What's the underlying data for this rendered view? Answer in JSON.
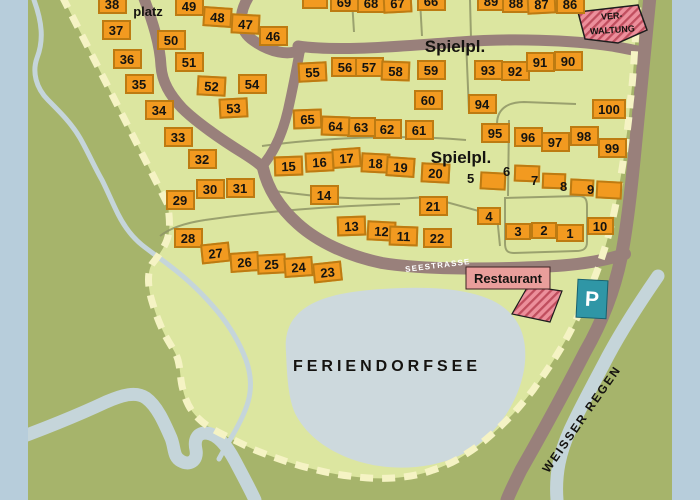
{
  "labels": {
    "spielplatz_partial": "platz",
    "spielplatz_top": "Spielpl.",
    "spielplatz_mid": "Spielpl.",
    "verwaltung_line1": "VER-",
    "verwaltung_line2": "WALTUNG",
    "seestrasse": "SEESTRASSE",
    "restaurant": "Restaurant",
    "parking": "P",
    "lake": "FERIENDORFSEE",
    "river": "WEISSER REGEN"
  },
  "plots": [
    {
      "n": "38",
      "x": 112,
      "y": 4
    },
    {
      "n": "37",
      "x": 116,
      "y": 30
    },
    {
      "n": "36",
      "x": 127,
      "y": 59
    },
    {
      "n": "35",
      "x": 139,
      "y": 84
    },
    {
      "n": "34",
      "x": 159,
      "y": 110
    },
    {
      "n": "33",
      "x": 178,
      "y": 137
    },
    {
      "n": "32",
      "x": 202,
      "y": 159
    },
    {
      "n": "30",
      "x": 210,
      "y": 189
    },
    {
      "n": "31",
      "x": 240,
      "y": 188
    },
    {
      "n": "29",
      "x": 180,
      "y": 200
    },
    {
      "n": "28",
      "x": 188,
      "y": 238
    },
    {
      "n": "27",
      "x": 215,
      "y": 253,
      "r": -6
    },
    {
      "n": "26",
      "x": 244,
      "y": 262,
      "r": -4
    },
    {
      "n": "25",
      "x": 271,
      "y": 264,
      "r": -3
    },
    {
      "n": "24",
      "x": 298,
      "y": 267,
      "r": -4
    },
    {
      "n": "23",
      "x": 327,
      "y": 272,
      "r": -6
    },
    {
      "n": "49",
      "x": 189,
      "y": 6
    },
    {
      "n": "48",
      "x": 217,
      "y": 17,
      "r": 4
    },
    {
      "n": "47",
      "x": 245,
      "y": 24,
      "r": 3
    },
    {
      "n": "46",
      "x": 273,
      "y": 36
    },
    {
      "n": "50",
      "x": 171,
      "y": 40
    },
    {
      "n": "51",
      "x": 189,
      "y": 62
    },
    {
      "n": "52",
      "x": 211,
      "y": 86,
      "r": 3
    },
    {
      "n": "53",
      "x": 233,
      "y": 108,
      "r": -3
    },
    {
      "n": "54",
      "x": 252,
      "y": 84
    },
    {
      "n": "55",
      "x": 312,
      "y": 72,
      "r": -3
    },
    {
      "n": "56",
      "x": 345,
      "y": 67
    },
    {
      "n": "57",
      "x": 369,
      "y": 67
    },
    {
      "n": "58",
      "x": 395,
      "y": 71,
      "r": 2
    },
    {
      "n": "59",
      "x": 431,
      "y": 70
    },
    {
      "n": "60",
      "x": 428,
      "y": 100
    },
    {
      "n": "61",
      "x": 419,
      "y": 130
    },
    {
      "n": "62",
      "x": 387,
      "y": 129
    },
    {
      "n": "63",
      "x": 361,
      "y": 127
    },
    {
      "n": "64",
      "x": 335,
      "y": 126,
      "r": 2
    },
    {
      "n": "65",
      "x": 307,
      "y": 119,
      "r": -2
    },
    {
      "n": "",
      "x": 315,
      "y": -1,
      "w": 26
    },
    {
      "n": "69",
      "x": 344,
      "y": 2
    },
    {
      "n": "68",
      "x": 371,
      "y": 3
    },
    {
      "n": "67",
      "x": 397,
      "y": 3,
      "r": -3
    },
    {
      "n": "66",
      "x": 431,
      "y": 1
    },
    {
      "n": "89",
      "x": 491,
      "y": 1
    },
    {
      "n": "88",
      "x": 516,
      "y": 3
    },
    {
      "n": "87",
      "x": 541,
      "y": 4,
      "r": -3
    },
    {
      "n": "86",
      "x": 570,
      "y": 4
    },
    {
      "n": "93",
      "x": 488,
      "y": 70
    },
    {
      "n": "92",
      "x": 515,
      "y": 71
    },
    {
      "n": "91",
      "x": 540,
      "y": 62
    },
    {
      "n": "90",
      "x": 568,
      "y": 61
    },
    {
      "n": "94",
      "x": 482,
      "y": 104
    },
    {
      "n": "100",
      "x": 609,
      "y": 109,
      "w": 34
    },
    {
      "n": "95",
      "x": 495,
      "y": 133
    },
    {
      "n": "96",
      "x": 528,
      "y": 137
    },
    {
      "n": "97",
      "x": 555,
      "y": 142
    },
    {
      "n": "98",
      "x": 584,
      "y": 136
    },
    {
      "n": "99",
      "x": 612,
      "y": 148
    },
    {
      "n": "15",
      "x": 288,
      "y": 166,
      "r": -2
    },
    {
      "n": "16",
      "x": 319,
      "y": 162,
      "r": -3
    },
    {
      "n": "17",
      "x": 346,
      "y": 158,
      "r": -4
    },
    {
      "n": "18",
      "x": 375,
      "y": 163,
      "r": 3
    },
    {
      "n": "19",
      "x": 400,
      "y": 167,
      "r": 4
    },
    {
      "n": "20",
      "x": 435,
      "y": 173,
      "r": 3
    },
    {
      "n": "14",
      "x": 324,
      "y": 195
    },
    {
      "n": "21",
      "x": 433,
      "y": 206
    },
    {
      "n": "13",
      "x": 351,
      "y": 226,
      "r": -2
    },
    {
      "n": "12",
      "x": 381,
      "y": 231,
      "r": 3
    },
    {
      "n": "11",
      "x": 403,
      "y": 236,
      "r": 2
    },
    {
      "n": "22",
      "x": 437,
      "y": 238
    },
    {
      "n": "4",
      "x": 489,
      "y": 216,
      "w": 24,
      "h": 18
    },
    {
      "n": "3",
      "x": 518,
      "y": 231,
      "w": 26,
      "h": 17
    },
    {
      "n": "2",
      "x": 544,
      "y": 230,
      "w": 26,
      "h": 17
    },
    {
      "n": "1",
      "x": 570,
      "y": 233,
      "w": 28,
      "h": 18
    },
    {
      "n": "10",
      "x": 600,
      "y": 226,
      "w": 27,
      "h": 18
    }
  ],
  "building_plots": [
    {
      "n": "5",
      "lx": 472,
      "ly": 179,
      "x": 493,
      "y": 181,
      "w": 26,
      "h": 18,
      "r": 3
    },
    {
      "n": "6",
      "lx": 508,
      "ly": 172,
      "x": 527,
      "y": 173,
      "w": 26,
      "h": 17,
      "r": 2
    },
    {
      "n": "7",
      "lx": 536,
      "ly": 181,
      "x": 554,
      "y": 181,
      "w": 24,
      "h": 16,
      "r": 2
    },
    {
      "n": "8",
      "lx": 565,
      "ly": 187,
      "x": 582,
      "y": 187,
      "w": 24,
      "h": 17,
      "r": 3
    },
    {
      "n": "9",
      "lx": 592,
      "ly": 190,
      "x": 609,
      "y": 190,
      "w": 26,
      "h": 18,
      "r": 3
    }
  ],
  "colors": {
    "plot_fill": "#f29a20",
    "plot_border": "#bd7b12",
    "road": "#99807b",
    "inside_green": "#dce6a0",
    "outside_green": "#a6b46b",
    "water": "#c5d5da",
    "lake": "#cdd9dd",
    "boundary_dash": "#f5f3c4",
    "building_pink": "#ec8f9b",
    "hatch_line": "#c04e5e",
    "parking_teal": "#2f96a6",
    "frame_blue": "#b7cddb"
  }
}
